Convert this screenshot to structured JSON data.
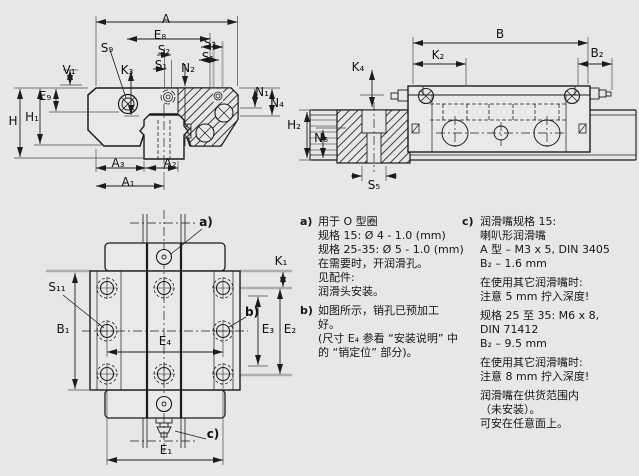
{
  "figure": {
    "kind": "linear-guide-dimension-drawing",
    "background": "#e7e7e7",
    "line_color": "#1c1c1c",
    "gray_reference_color": "#adadad"
  },
  "views": {
    "cross_section": {
      "labels": {
        "A": "A",
        "E8": "E₈",
        "S2_left": "S₂",
        "S1_left": "S₁",
        "N2": "N₂",
        "S2_right": "S₂",
        "S1_right": "S₁",
        "S9": "S₉",
        "K3": "K₃",
        "V1": "V₁",
        "E9": "E₉",
        "H": "H",
        "H1": "H₁",
        "N1": "N₁",
        "N4": "N₄",
        "A3": "A₃",
        "A2": "A₂",
        "A1": "A₁"
      }
    },
    "side_view": {
      "labels": {
        "B": "B",
        "K2": "K₂",
        "B2": "B₂",
        "K4": "K₄",
        "H2": "H₂",
        "N6": "N₆",
        "S5": "S₅"
      }
    },
    "top_view": {
      "labels": {
        "a": "a)",
        "K1": "K₁",
        "S11": "S₁₁",
        "b": "b)",
        "B1": "B₁",
        "E3": "E₃",
        "E2": "E₂",
        "E4": "E₄",
        "c": "c)",
        "E1": "E₁"
      }
    }
  },
  "notes": {
    "a": {
      "tag": "a)",
      "lines": [
        "用于 O 型圈",
        "规格 15: Ø 4 - 1.0 (mm)",
        "规格 25-35: Ø 5 - 1.0 (mm)",
        "在需要时，开润滑孔。",
        "见配件:",
        "润滑头安装。"
      ]
    },
    "b": {
      "tag": "b)",
      "lines": [
        "如图所示，销孔已预加工",
        "好。",
        "(尺寸 E₄ 参看 “安装说明” 中",
        "的 “销定位” 部分)。"
      ]
    },
    "c": {
      "tag": "c)",
      "paragraphs": [
        [
          "润滑嘴规格 15:",
          "喇叭形润滑嘴",
          "A 型 – M3 x 5, DIN 3405",
          "B₂ – 1.6 mm"
        ],
        [
          "在使用其它润滑嘴时:",
          "注意 5 mm 拧入深度!"
        ],
        [
          "规格 25 至 35: M6 x 8,",
          "DIN 71412",
          "B₂ – 9.5 mm"
        ],
        [
          "在使用其它润滑嘴时:",
          "注意 8 mm 拧入深度!"
        ],
        [
          "润滑嘴在供货范围内",
          "（未安装）。",
          "可安在任意面上。"
        ]
      ]
    }
  }
}
